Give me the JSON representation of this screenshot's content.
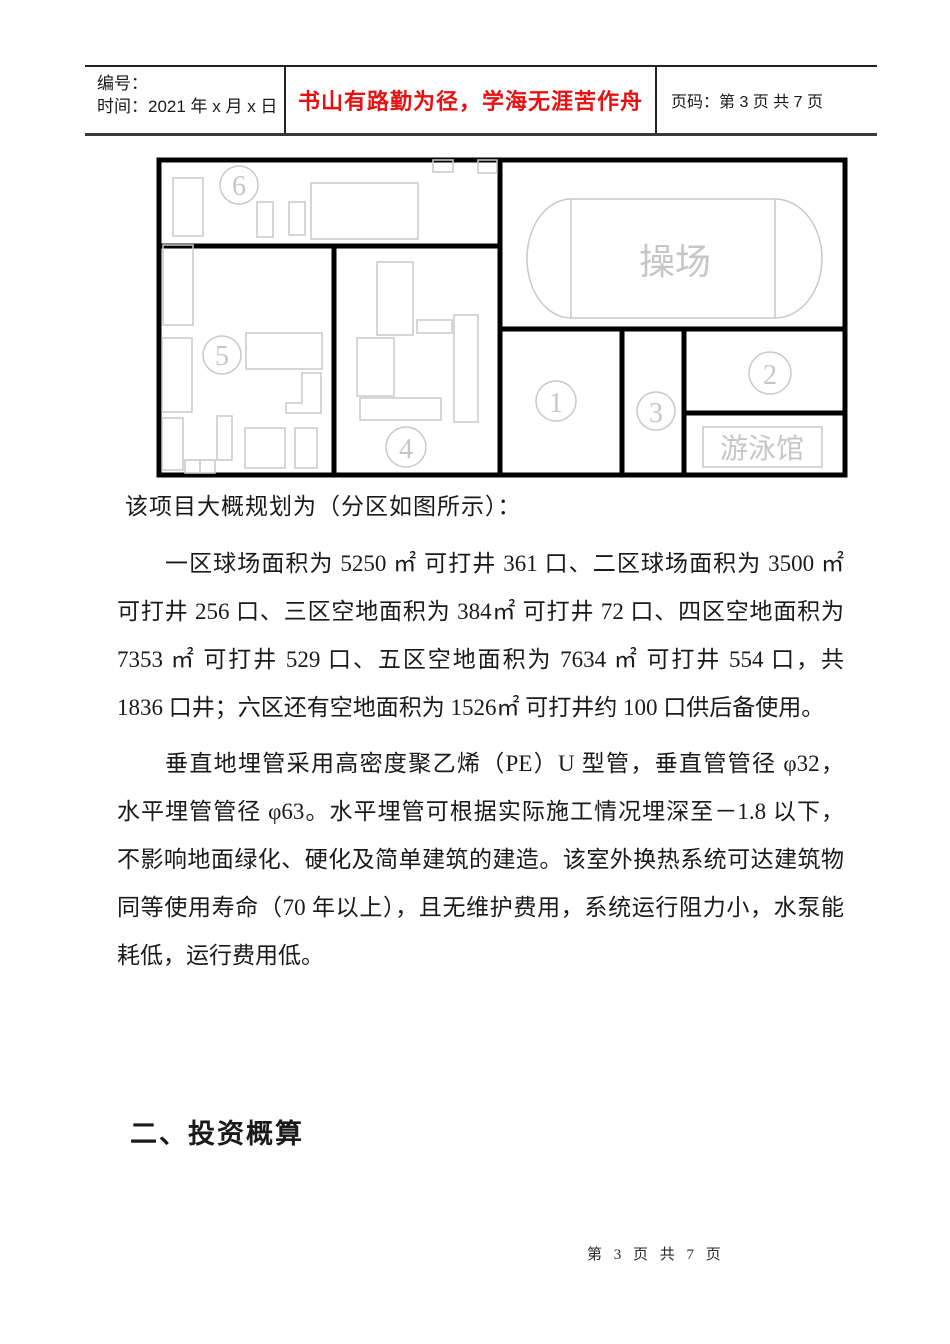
{
  "header": {
    "no_label": "编号：",
    "time_label": "时间：2021 年 x 月 x 日",
    "motto": "书山有路勤为径，学海无涯苦作舟",
    "motto_color": "#e81010",
    "page_label": "页码：第 3 页  共 7 页"
  },
  "diagram": {
    "line_color": "#c9c9c9",
    "wall_color": "#000000",
    "playground_label": "操场",
    "pool_label": "游泳馆",
    "zone_numbers": {
      "z1": "1",
      "z2": "2",
      "z3": "3",
      "z4": "4",
      "z5": "5",
      "z6": "6"
    }
  },
  "body": {
    "intro": "该项目大概规划为（分区如图所示）：",
    "para1_lines": [
      "一区球场面积为 5250 ㎡ 可打井 361 口、二区球场面积为 3500 ㎡",
      "可打井 256 口、三区空地面积为 384㎡ 可打井 72 口、四区空地面积为",
      "7353 ㎡ 可打井 529 口、五区空地面积为 7634 ㎡ 可打井 554 口，共",
      "1836 口井；六区还有空地面积为 1526㎡ 可打井约 100 口供后备使用。"
    ],
    "para2_lines": [
      "垂直地埋管采用高密度聚乙烯（PE）U 型管，垂直管管径 φ32，",
      "水平埋管管径 φ63。水平埋管可根据实际施工情况埋深至－1.8 以下，",
      "不影响地面绿化、硬化及简单建筑的建造。该室外换热系统可达建筑物",
      "同等使用寿命（70 年以上），且无维护费用，系统运行阻力小，水泵能",
      "耗低，运行费用低。"
    ]
  },
  "heading2": "二、投资概算",
  "footer": "第 3 页 共 7 页"
}
